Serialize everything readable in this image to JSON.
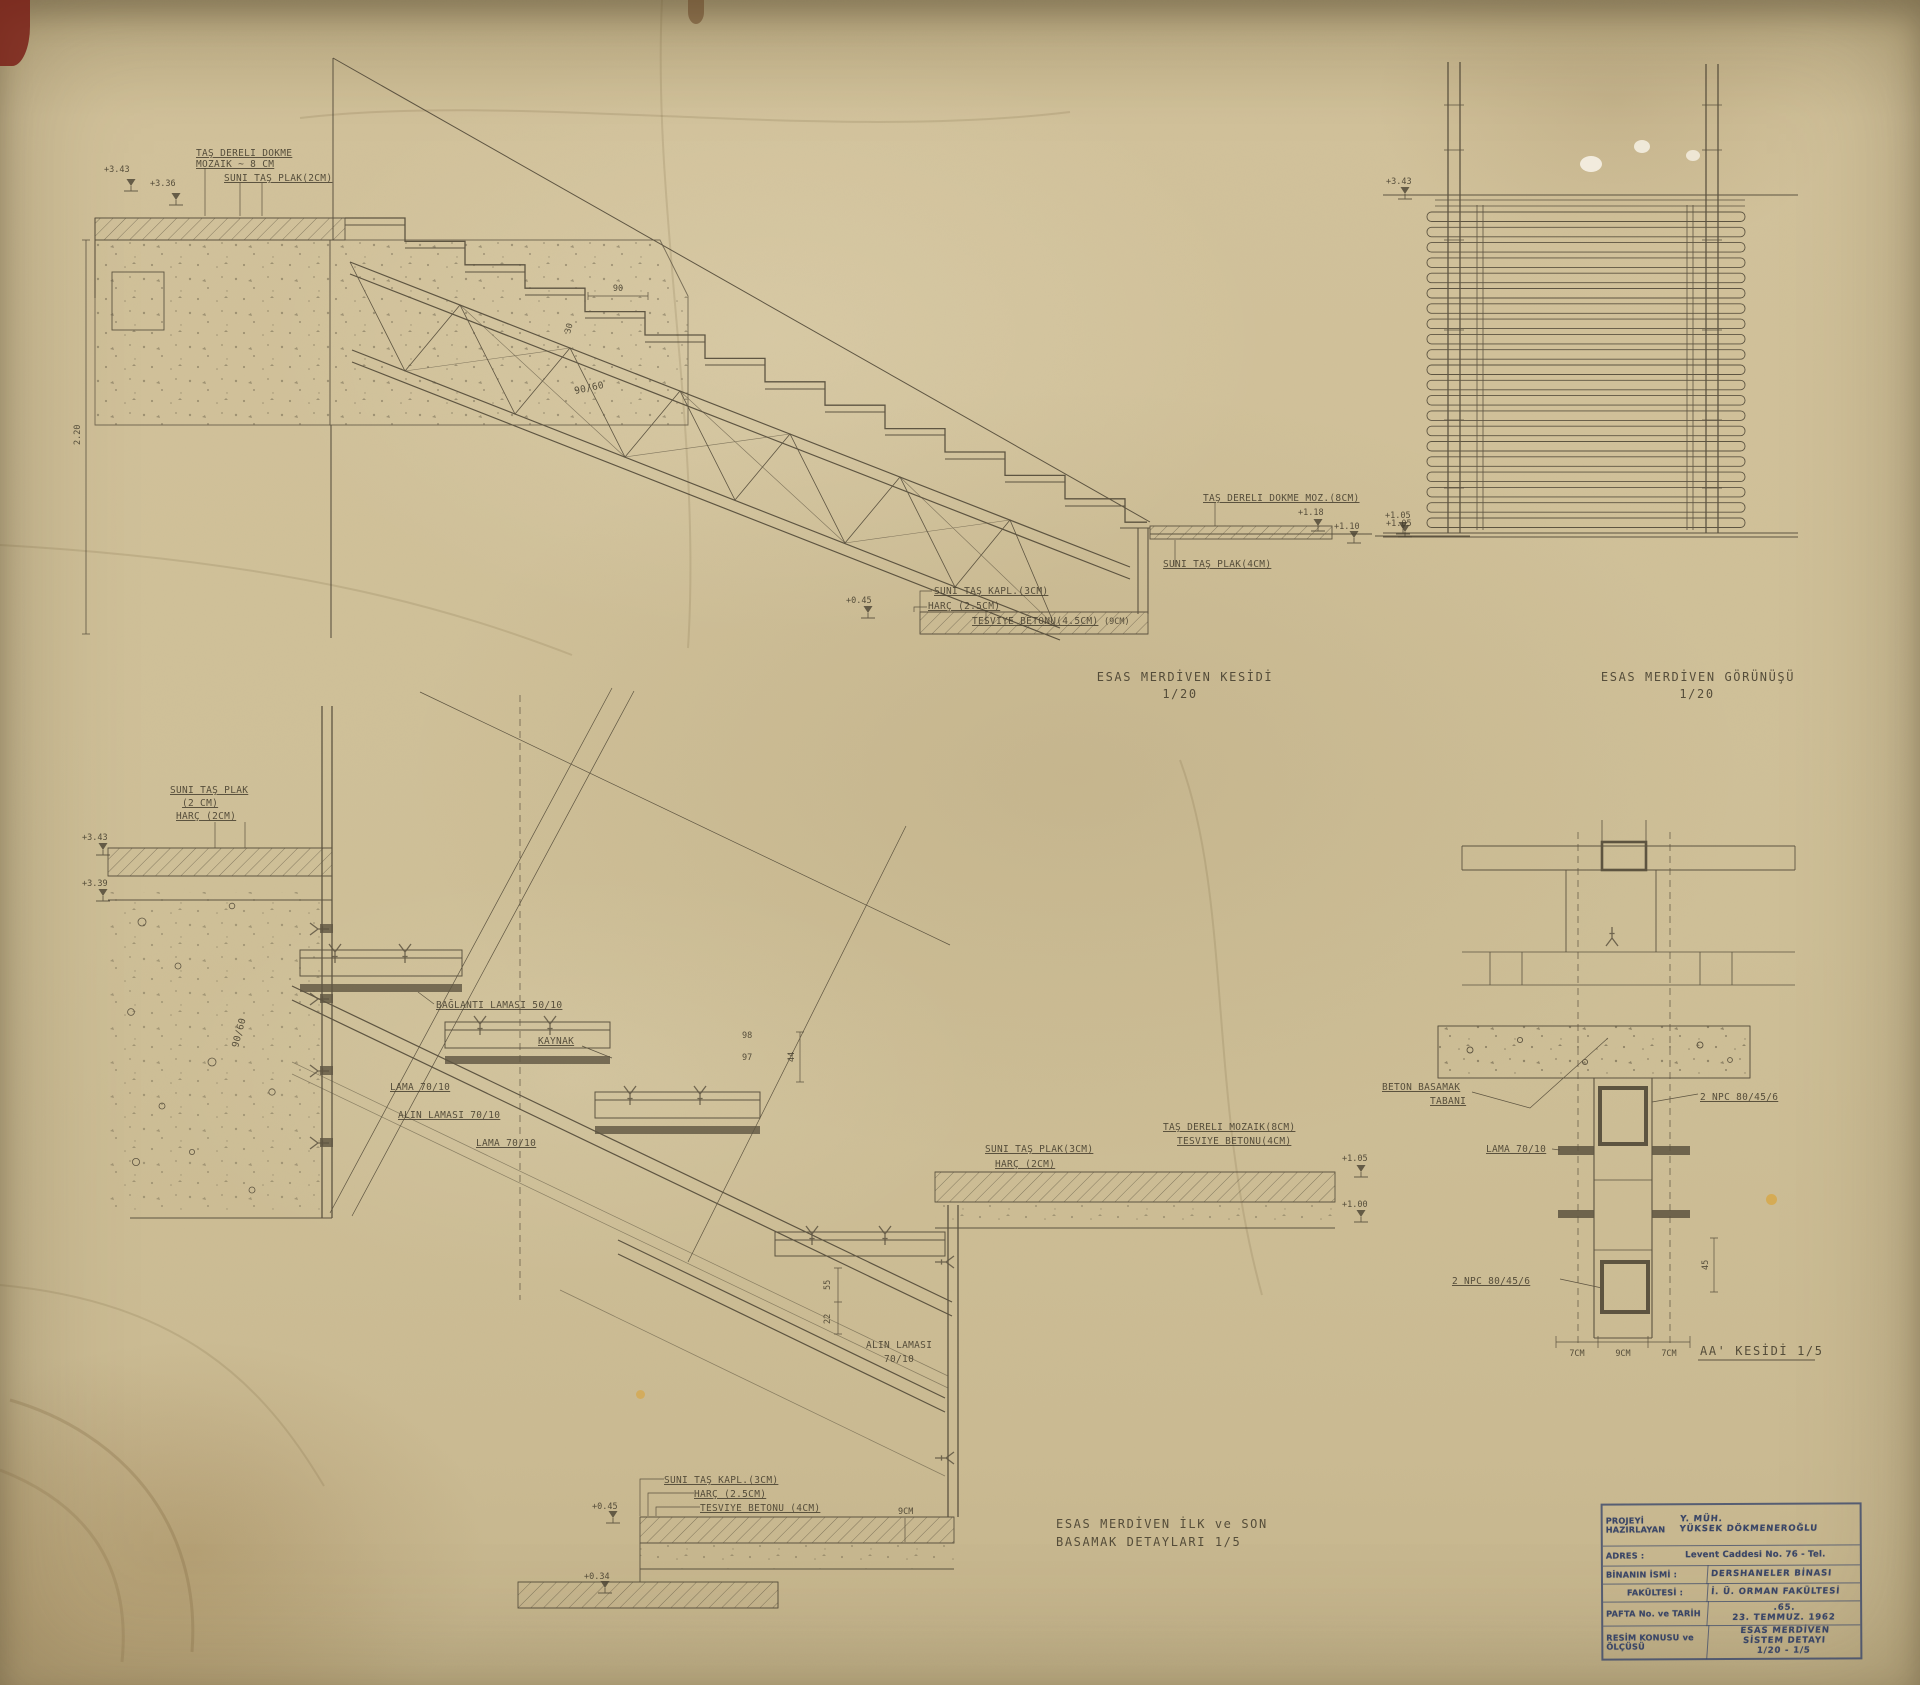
{
  "paper": {
    "bg": "#cfc098",
    "ink": "#4a4232",
    "stamp_ink": "#394566"
  },
  "sec": {
    "note_top1": "TAŞ DERELİ DÖKME",
    "note_top2": "MOZAİK ~ 8 CM",
    "note_top3": "SUNİ TAŞ PLAK(2CM)",
    "lvl_343": "+3.43",
    "lvl_336": "+3.36",
    "dim_9060": "90/60",
    "dim_220": "2.20",
    "dim_90": "90",
    "dim_30": "30",
    "note_moz": "TAŞ DERELİ DÖKME MOZ.(8CM)",
    "lvl_118": "+1.18",
    "lvl_110": "+1.10",
    "lvl_105": "+1.05",
    "note_plak4": "SUNİ TAŞ PLAK(4CM)",
    "note_kapl": "SUNİ TAŞ KAPL.(3CM)",
    "note_harc": "HARÇ (2.5CM)",
    "note_tesv": "TESVİYE BETONU(4.5CM)",
    "note_9cm": "(9CM)",
    "lvl_045": "+0.45",
    "cap1": "ESAS MERDİVEN KESİDİ",
    "cap2": "1/20"
  },
  "elev": {
    "lvl_343": "+3.43",
    "lvl_105": "+1.05",
    "cap1": "ESAS MERDİVEN GÖRÜNÜŞÜ",
    "cap2": "1/20"
  },
  "det": {
    "note_plak1": "SUNİ TAŞ PLAK",
    "note_plak2": "(2 CM)",
    "note_plak3": "HARÇ (2CM)",
    "lvl_343": "+3.43",
    "lvl_339": "+3.39",
    "dim_9060": "90/60",
    "lama_bag": "BAĞLANTI LAMASI 50/10",
    "kaynak": "KAYNAK",
    "lama1": "LAMA 70/10",
    "alin1": "ALIN LAMASI 70/10",
    "lama2": "LAMA 70/10",
    "dim_98": "98",
    "dim_97": "97",
    "dim_44": "44",
    "note_moz8": "TAŞ DERELİ MOZAİK(8CM)",
    "note_tesv4": "TESVİYE BETONU(4CM)",
    "note_plak3cm": "SUNİ TAŞ PLAK(3CM)",
    "note_harc2": "HARÇ (2CM)",
    "lvl_105": "+1.05",
    "lvl_100": "+1.00",
    "dim_55": "55",
    "dim_22": "22",
    "alin2a": "ALIN LAMASI",
    "alin2b": "70/10",
    "note_kapl3": "SUNİ TAŞ KAPL.(3CM)",
    "note_harc25": "HARÇ (2.5CM)",
    "note_tesv45": "TESVİYE BETONU (4CM)",
    "note_9cm": "9CM",
    "lvl_045": "+0.45",
    "lvl_034": "+0.34",
    "cap1": "ESAS MERDİVEN İLK ve SON",
    "cap2": "BASAMAK DETAYLARI 1/5"
  },
  "aa": {
    "beton1": "BETON BASAMAK",
    "beton2": "TABANI",
    "lama": "LAMA 70/10",
    "npc_top": "2 NPC 80/45/6",
    "npc_bot": "2 NPC 80/45/6",
    "dim45": "45",
    "dim7a": "7CM",
    "dim9": "9CM",
    "dim7b": "7CM",
    "cap": "AA' KESİDİ 1/5"
  },
  "tb": {
    "r1_label": "PROJEYİ HAZIRLAYAN",
    "r1_value1": "Y. MÜH.",
    "r1_value2": "YÜKSEK DÖKMENEROĞLU",
    "r2_label": "ADRES :",
    "r2_value": "Levent Caddesi No. 76 - Tel.",
    "r3_label": "BİNANIN İSMİ :",
    "r3_value": "DERSHANELER BİNASI",
    "r4_label": "FAKÜLTESİ :",
    "r4_value": "İ. Ü. ORMAN FAKÜLTESİ",
    "r5_label": "PAFTA No. ve TARİH",
    "r5_value1": ".65.",
    "r5_value2": "23. TEMMUZ. 1962",
    "r6_label": "RESİM KONUSU ve ÖLÇÜSÜ",
    "r6_value1": "ESAS MERDİVEN",
    "r6_value2": "SİSTEM DETAYI",
    "r6_value3": "1/20 - 1/5"
  }
}
